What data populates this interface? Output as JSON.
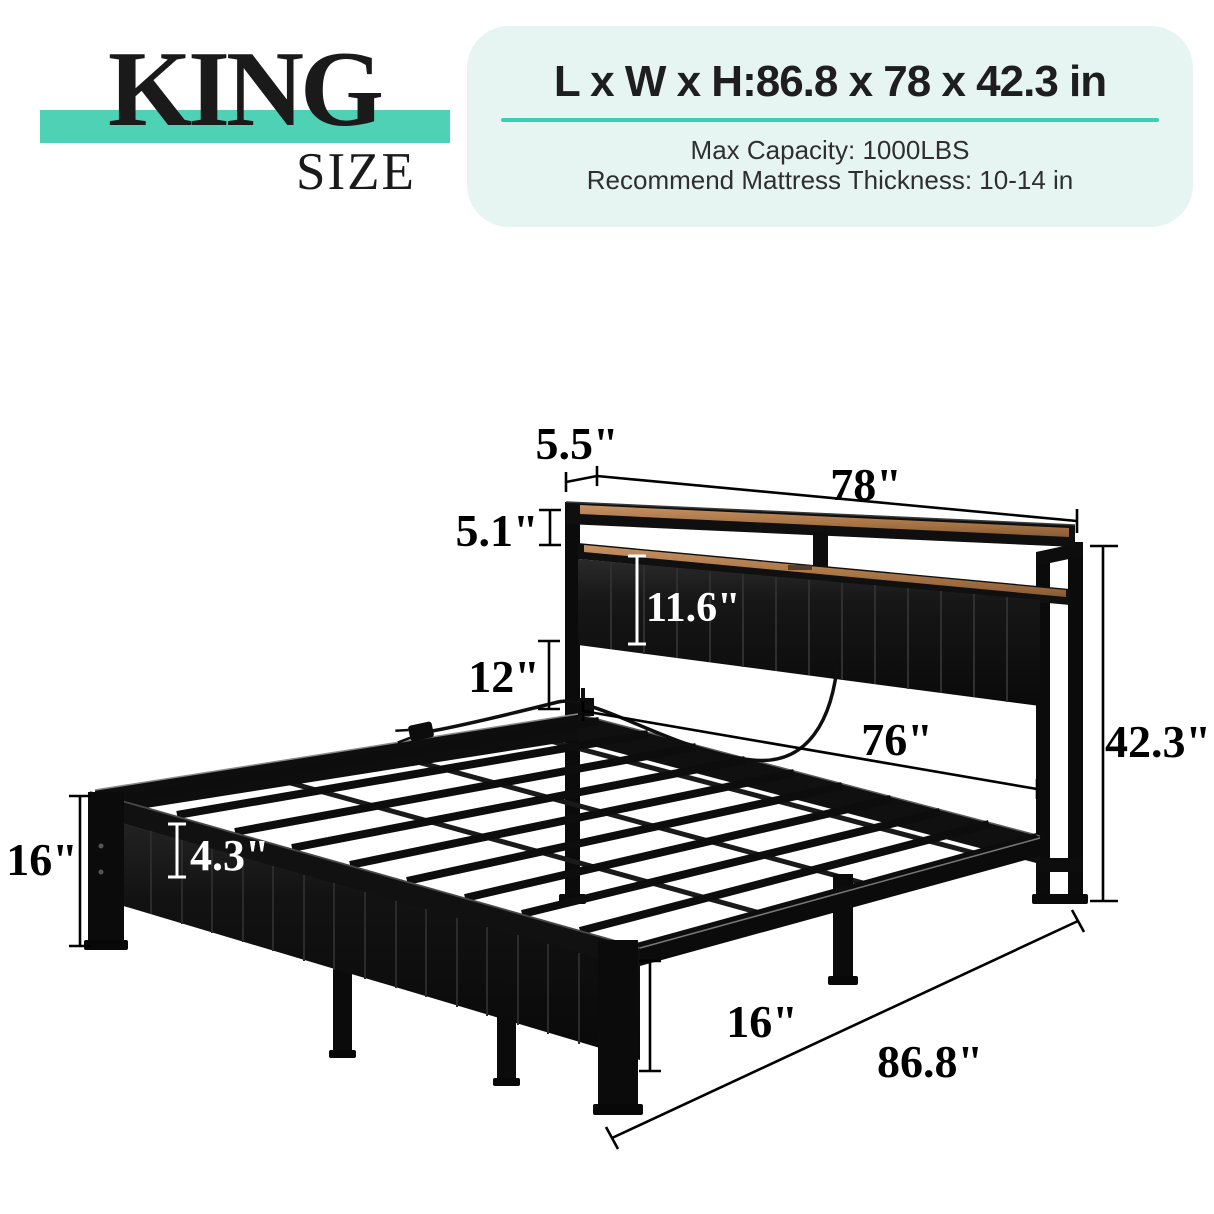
{
  "size_label": {
    "name": "KING",
    "descriptor": "SIZE"
  },
  "spec_box": {
    "dimensions_title": "L x W x H:86.8 x 78 x 42.3 in",
    "max_capacity": "Max Capacity: 1000LBS",
    "mattress_recommendation": "Recommend Mattress Thickness: 10-14 in"
  },
  "diagram": {
    "dimensions": {
      "shelf_depth": "5.5\"",
      "headboard_width": "78\"",
      "shelf_tier_height": "5.1\"",
      "headboard_panel_height": "11.6\"",
      "under_headboard_clearance": "12\"",
      "inner_width": "76\"",
      "overall_height": "42.3\"",
      "footboard_end_height": "16\"",
      "side_rail_height": "4.3\"",
      "leg_height": "16\"",
      "overall_length": "86.8\""
    }
  },
  "colors": {
    "accent_teal": "#4ed1b4",
    "underline_teal": "#3bcfb4",
    "spec_box_bg": "#e7f5f2",
    "wood": "#b5834f",
    "frame_black": "#0f0f0f"
  }
}
